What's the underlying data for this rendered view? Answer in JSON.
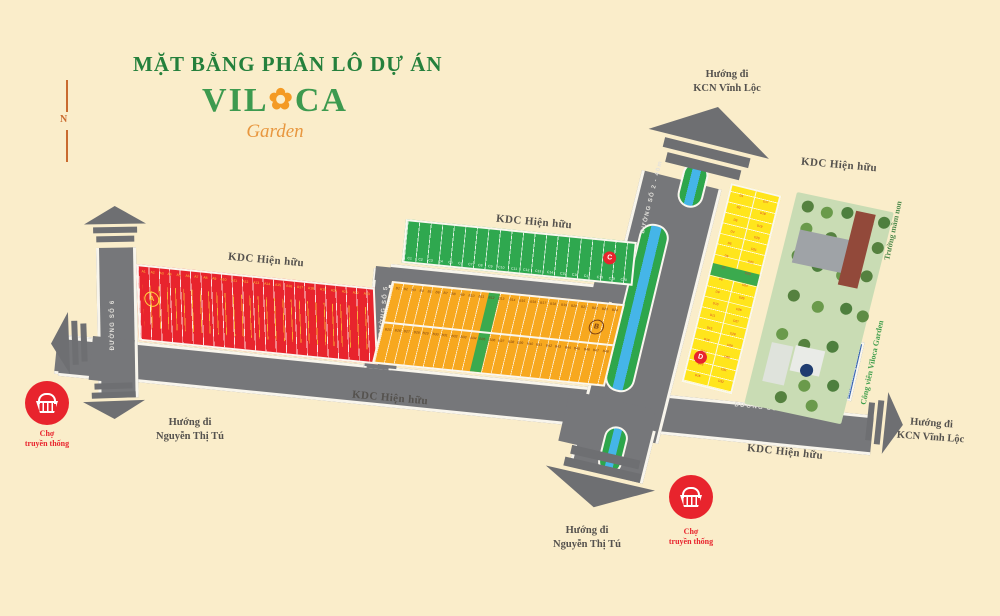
{
  "title": "MẶT BẰNG PHÂN LÔ DỰ ÁN",
  "logo": {
    "part1": "VIL",
    "flower": "✿",
    "part2": "CA",
    "sub": "Garden"
  },
  "compass": {
    "label": "N"
  },
  "labels": {
    "kdc": "KDC Hiện hữu",
    "school": "Trường mầm non",
    "park": "Công viên Viloca Garden"
  },
  "directions": {
    "kcn": {
      "line1": "Hướng đi",
      "line2": "KCN Vĩnh Lộc"
    },
    "nguyen": {
      "line1": "Hướng đi",
      "line2": "Nguyễn Thị Tú"
    }
  },
  "market": {
    "line1": "Chợ",
    "line2": "truyền thống"
  },
  "roads": {
    "main_left": "ĐƯỜNG SỐ 1 - 20 m",
    "main_right": "ĐƯỜNG SỐ 1 - 20m",
    "boulevard": "ĐƯỜNG SỐ 2 - 40m",
    "top": "ĐƯỜNG SỐ 4 - 12m",
    "mid": "ĐƯỜNG SỐ 5",
    "left": "ĐƯỜNG SỐ 6"
  },
  "blocks": {
    "a": {
      "label": "A",
      "lots": [
        "A1",
        "A2",
        "A3",
        "A4",
        "A5",
        "A6",
        "A7",
        "A8",
        "A9",
        "A10",
        "A11",
        "A12",
        "A13",
        "A14",
        "A15",
        "A16",
        "A17",
        "A18",
        "A19",
        "A20",
        "A21",
        "A22",
        "A23"
      ]
    },
    "b": {
      "label": "B",
      "lots_top": [
        "B1",
        "B2",
        "B3",
        "B4",
        "B5",
        "B6",
        "B7",
        "B8",
        "B9",
        "B10",
        "B11",
        "B12",
        "B13",
        "B14",
        "B15",
        "B16",
        "B17",
        "B18",
        "B19",
        "B20",
        "B21",
        "B22",
        "B23",
        "B24"
      ],
      "lots_bottom": [
        "B25",
        "B26",
        "B27",
        "B28",
        "B29",
        "B30",
        "B31",
        "B32",
        "B33",
        "B34",
        "B35",
        "B36",
        "B37",
        "B38",
        "B39",
        "B40",
        "B41",
        "B42",
        "B43",
        "B44",
        "B45",
        "B46",
        "B47",
        "B48"
      ]
    },
    "c": {
      "label": "C",
      "lots": [
        "C1",
        "C2",
        "C3",
        "C4",
        "C5",
        "C6",
        "C7",
        "C8",
        "C9",
        "C10",
        "C11",
        "C12",
        "C13",
        "C14",
        "C15",
        "C16",
        "C17",
        "C18",
        "C19",
        "C20"
      ]
    },
    "d": {
      "label": "D",
      "lots_left": [
        "D1",
        "D2",
        "D3",
        "D4",
        "D5",
        "D6",
        "D7",
        "D8",
        "D9",
        "D10",
        "D11",
        "D12",
        "D13",
        "D14",
        "D15",
        "D16"
      ],
      "lots_right": [
        "D17",
        "D18",
        "D19",
        "D20",
        "D21",
        "D22",
        "D23",
        "D24",
        "D25",
        "D26",
        "D27",
        "D28",
        "D29",
        "D30",
        "D31",
        "D32"
      ]
    },
    "e": {
      "label": "E",
      "lots": [
        "E1",
        "E2",
        "E3",
        "E4",
        "E5",
        "E6",
        "E7",
        "E8",
        "E9",
        "E10",
        "E11",
        "E12",
        "E13",
        "E14",
        "E15",
        "E16",
        "E17"
      ]
    }
  },
  "colors": {
    "background": "#FAEDCA",
    "road": "#76777A",
    "block_a": "#E8242D",
    "block_b": "#F7A81F",
    "block_c": "#2FA84F",
    "block_d": "#FFE51C",
    "block_e": "#3A67B1",
    "median_green": "#2EA64B",
    "median_blue": "#45B5E8",
    "title_green": "#25803C",
    "logo_orange": "#F49A24",
    "market_red": "#E8242D",
    "label_dark": "#55524E"
  }
}
